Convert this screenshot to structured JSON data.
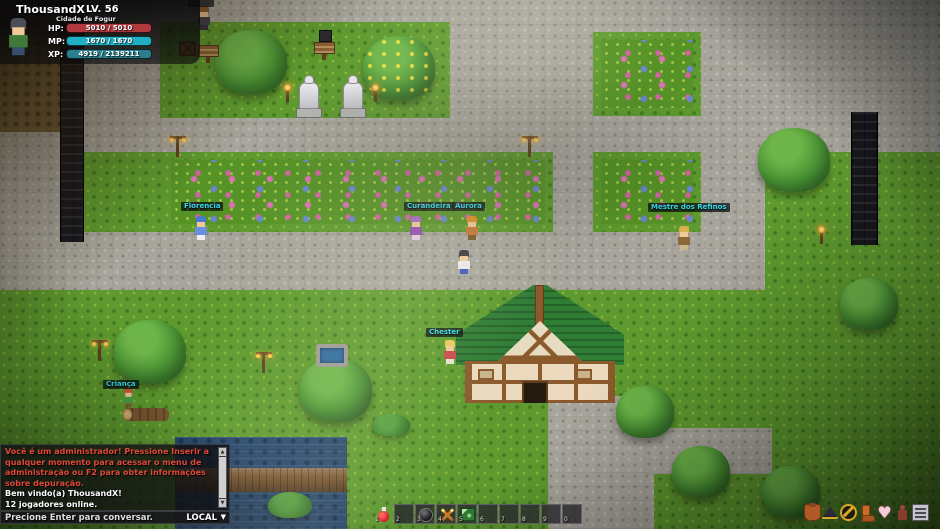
{
  "player_panel": {
    "name": "ThousandX",
    "level": "LV. 56",
    "location": "Cidade de Fogur",
    "hp_label": "HP:",
    "hp_value": "5010 / 5010",
    "hp_color": "#b23a3e",
    "mp_label": "MP:",
    "mp_value": "1670 / 1670",
    "mp_color": "#22aec2",
    "xp_label": "XP:",
    "xp_value": "4919 / 2139211",
    "xp_color": "#2b7e8e"
  },
  "chat": {
    "admin_color": "#e04838",
    "normal_color": "#ffffff",
    "messages": [
      {
        "type": "admin",
        "text": "Você é um administrador! Pressione Inserir a qualquer momento para acessar o menu de administração ou F2 para obter informações sobre depuração."
      },
      {
        "type": "normal",
        "text": "Bem vindo(a) ThousandX!"
      },
      {
        "type": "normal",
        "text": "12 jogadores online."
      },
      {
        "type": "normal",
        "text": "São 22:16"
      }
    ],
    "input_hint": "Precione Enter para conversar.",
    "channel": "LOCAL",
    "channel_arrow": "▼"
  },
  "hotbar": {
    "slots": [
      {
        "key": "1",
        "item": "health-potion"
      },
      {
        "key": "2",
        "item": ""
      },
      {
        "key": "3",
        "item": "black-orb"
      },
      {
        "key": "4",
        "item": "crossed-swords"
      },
      {
        "key": "5",
        "item": "green-rune"
      },
      {
        "key": "6",
        "item": ""
      },
      {
        "key": "7",
        "item": ""
      },
      {
        "key": "8",
        "item": ""
      },
      {
        "key": "9",
        "item": ""
      },
      {
        "key": "0",
        "item": ""
      }
    ]
  },
  "menu_bar": {
    "icons": [
      "supply-bag",
      "wizard-hat",
      "gold-emblem",
      "leather-boot",
      "heart",
      "character-figure",
      "menu-list"
    ]
  },
  "world": {
    "label_color": "#38d8ea",
    "npc_labels": [
      "Florencia",
      "Curandeira",
      "Aurora",
      "Mestre dos Refinos",
      "Chester",
      "Criança"
    ]
  }
}
